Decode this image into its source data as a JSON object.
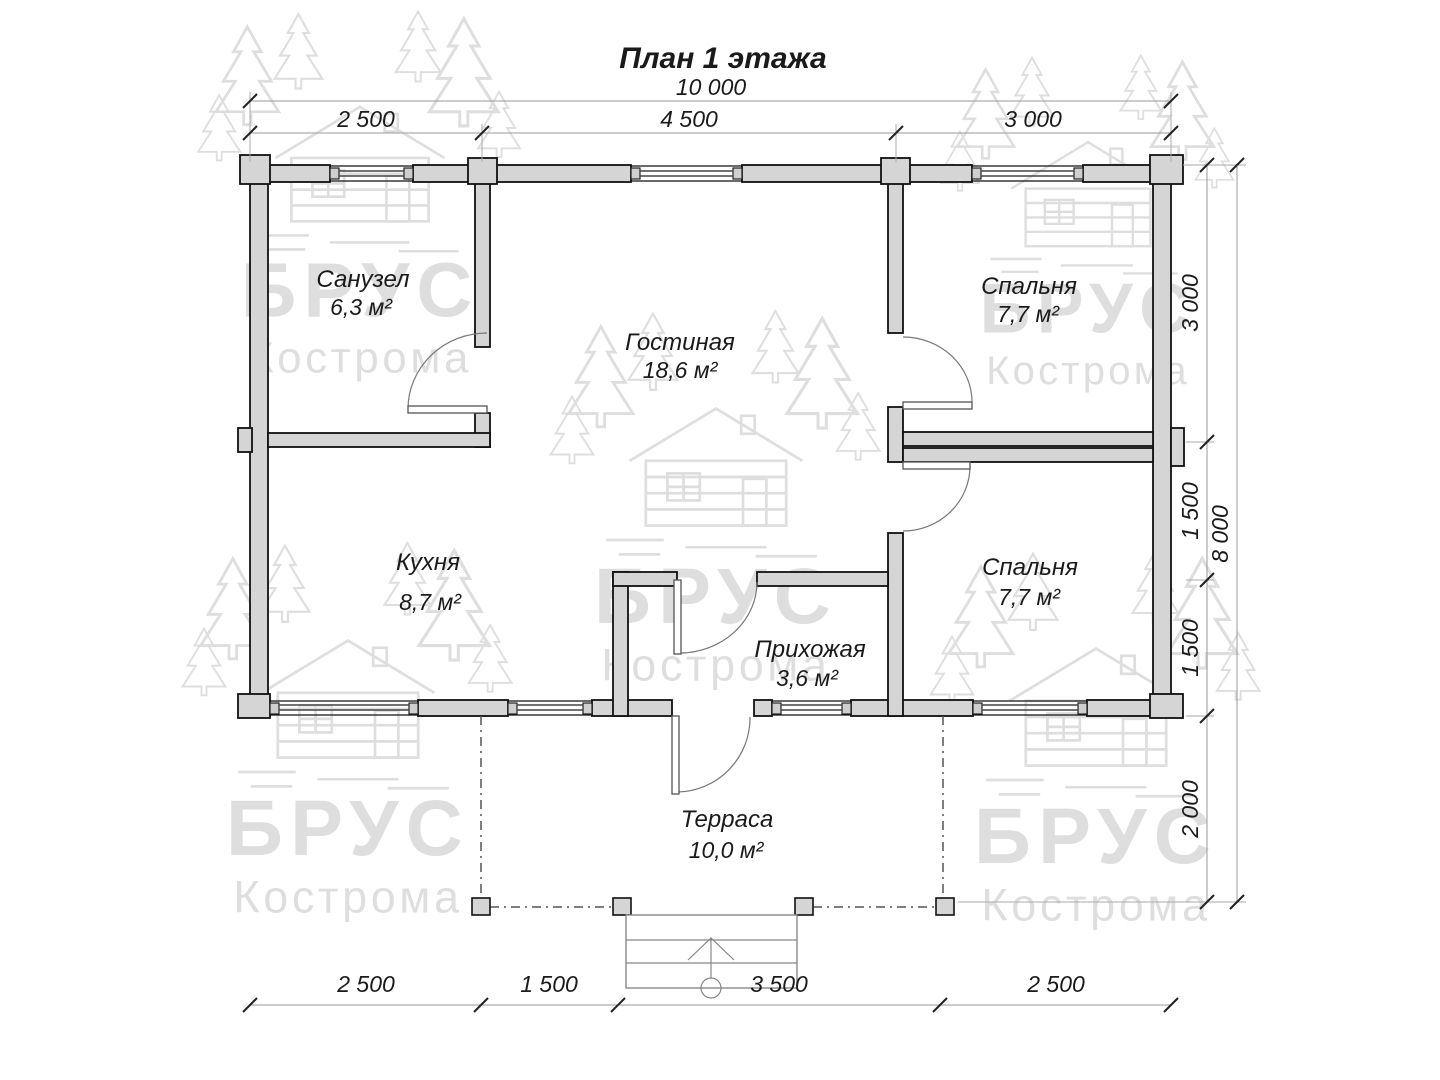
{
  "title": "План 1 этажа",
  "watermark": {
    "brand": "БРУС",
    "city": "Кострома"
  },
  "rooms": {
    "bathroom": {
      "name": "Санузел",
      "area": "6,3 м²"
    },
    "living": {
      "name": "Гостиная",
      "area": "18,6 м²"
    },
    "bedroom1": {
      "name": "Спальня",
      "area": "7,7 м²"
    },
    "kitchen": {
      "name": "Кухня",
      "area": "8,7 м²"
    },
    "hallway": {
      "name": "Прихожая",
      "area": "3,6 м²"
    },
    "bedroom2": {
      "name": "Спальня",
      "area": "7,7 м²"
    },
    "terrace": {
      "name": "Терраса",
      "area": "10,0 м²"
    }
  },
  "dimensions": {
    "top_total": "10 000",
    "top": [
      "2 500",
      "4 500",
      "3 000"
    ],
    "right": [
      "3 000",
      "1 500",
      "1 500",
      "2 000"
    ],
    "right_total": "8 000",
    "bottom": [
      "2 500",
      "1 500",
      "3 500",
      "2 500"
    ]
  }
}
